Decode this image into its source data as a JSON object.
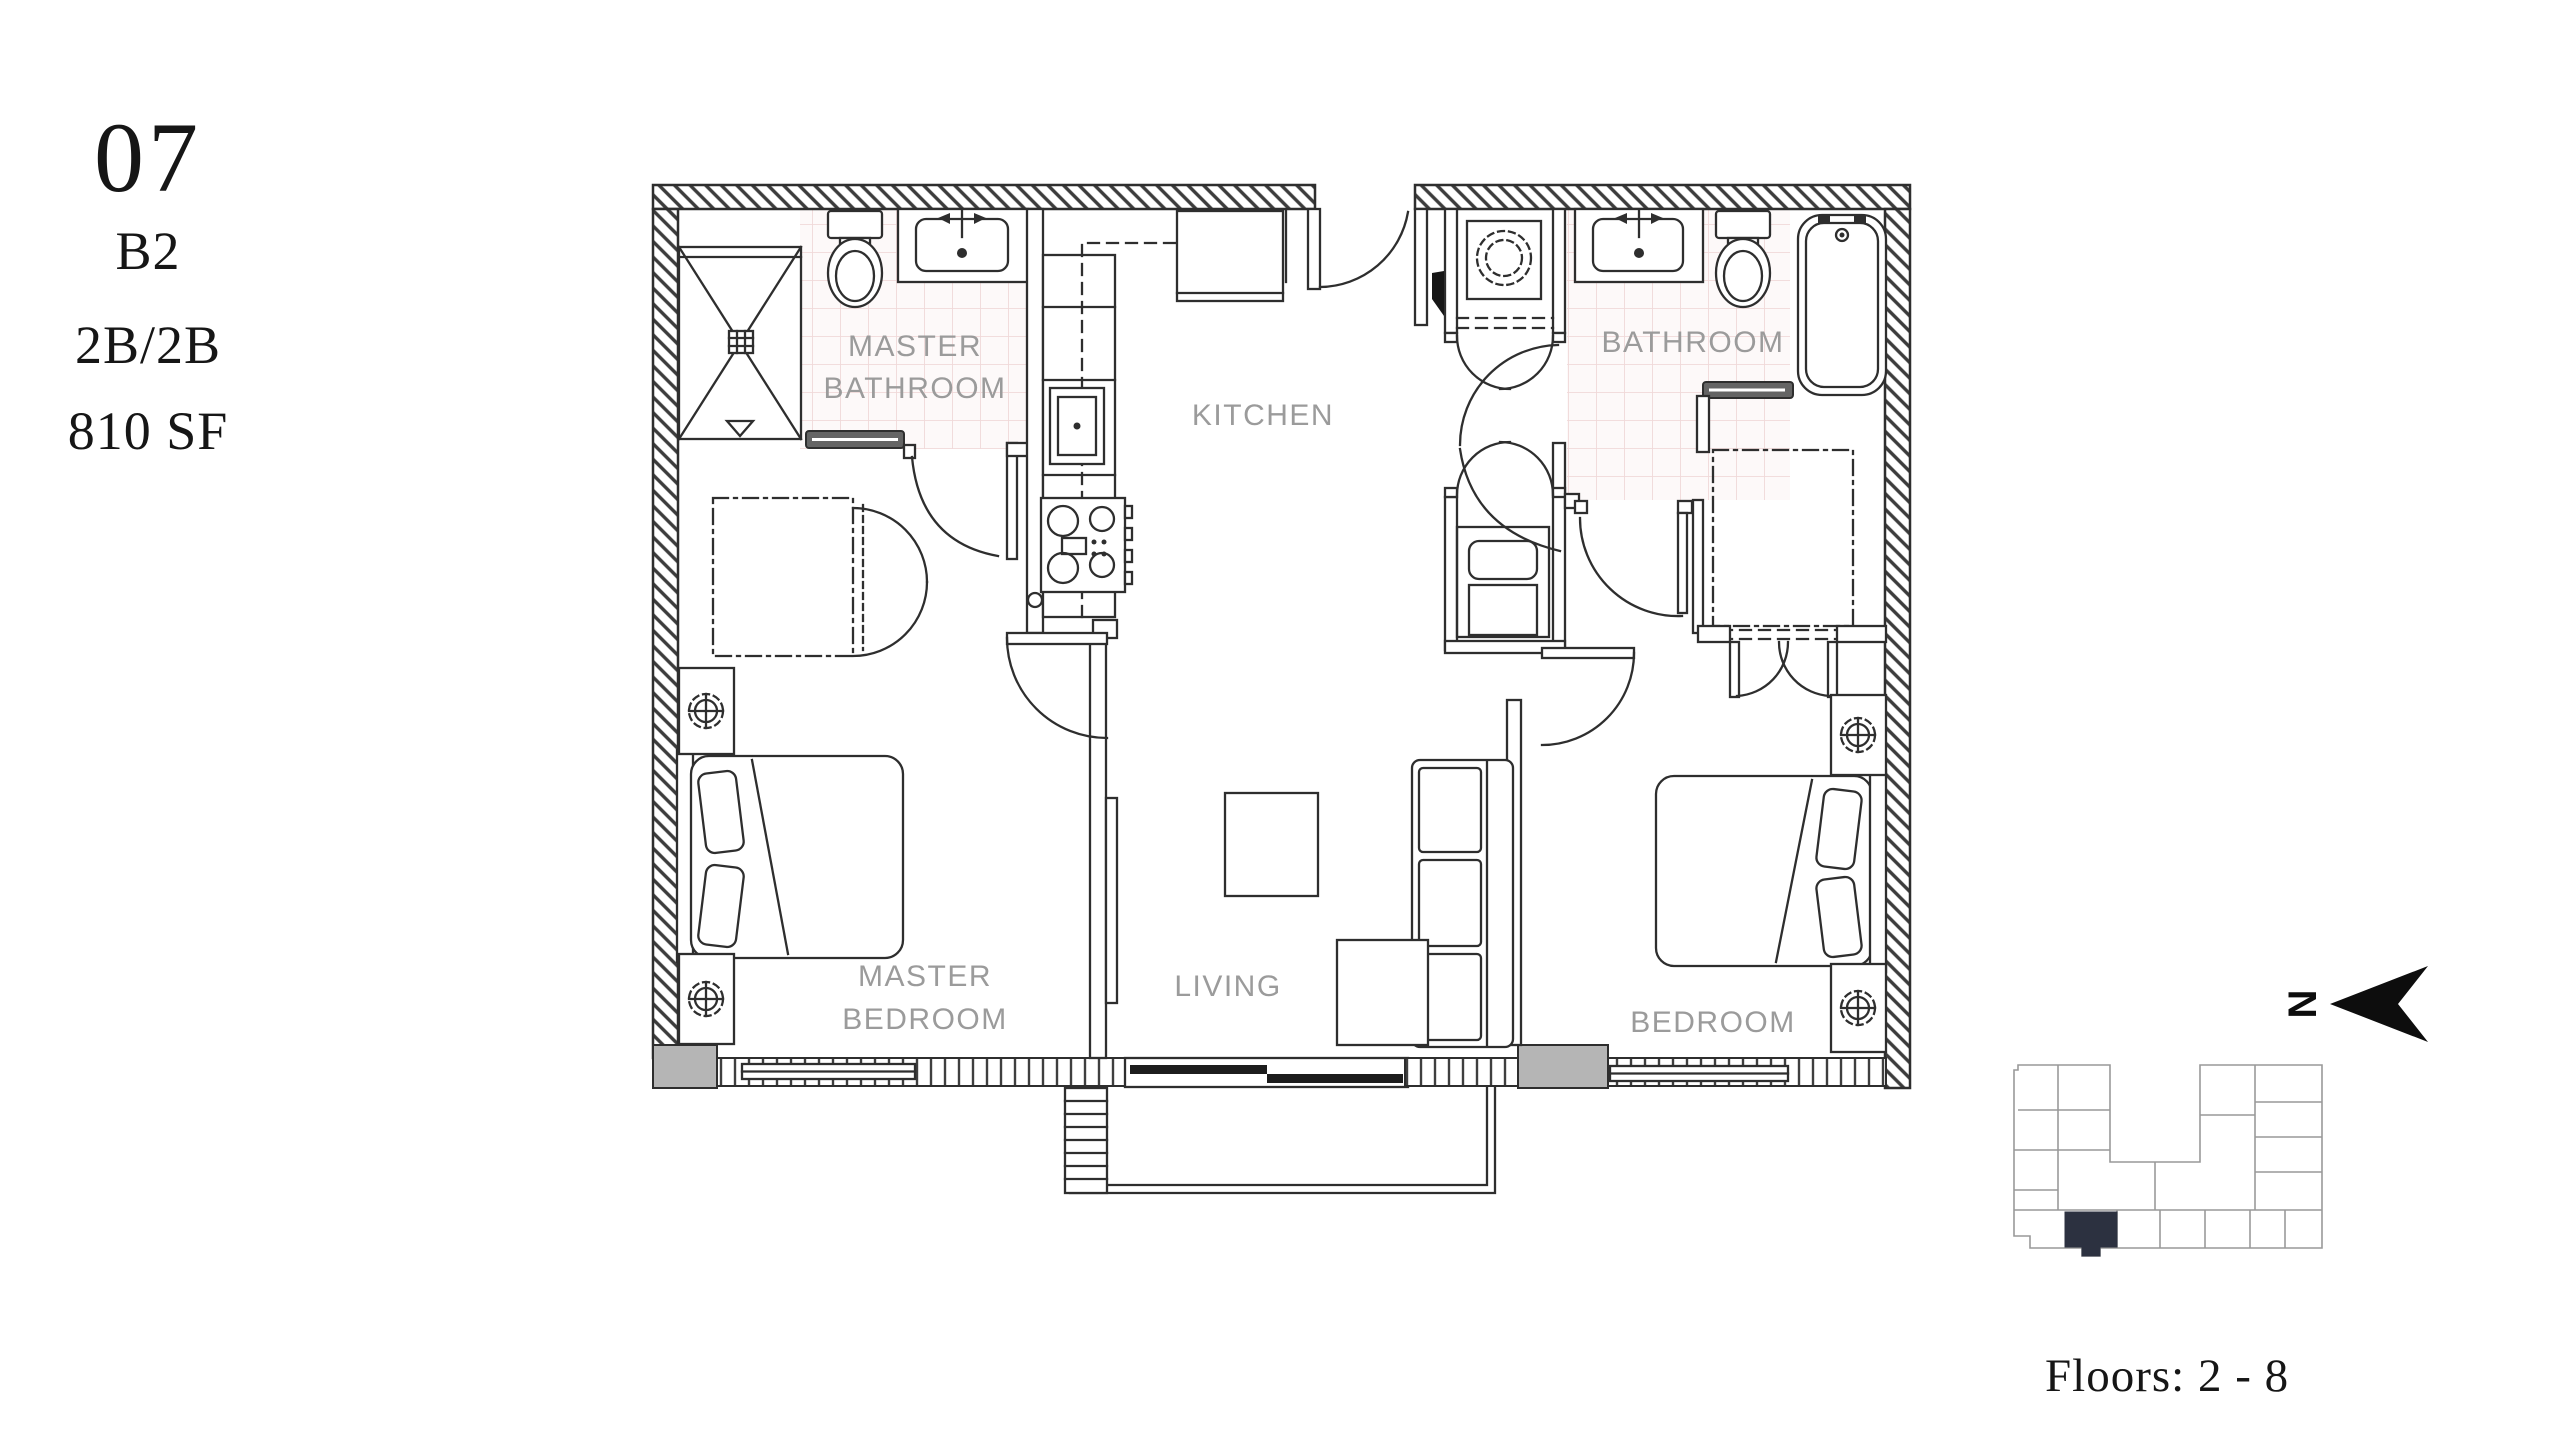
{
  "unit_info": {
    "number": "07",
    "plan_code": "B2",
    "beds_baths": "2B/2B",
    "area": "810 SF"
  },
  "rooms": {
    "master_bathroom": [
      "MASTER",
      "BATHROOM"
    ],
    "kitchen": "KITCHEN",
    "bathroom": "BATHROOM",
    "master_bedroom": [
      "MASTER",
      "BEDROOM"
    ],
    "living": "LIVING",
    "bedroom": "BEDROOM"
  },
  "key_plan": {
    "floors_label": "Floors: 2 - 8"
  },
  "compass": {
    "north_label": "N"
  },
  "colors": {
    "background": "#ffffff",
    "line": "#2e2e2e",
    "room_label": "#9b9b9b",
    "tile_line": "#f0d9d9",
    "tile_fill": "#fdf9f9",
    "threshold": "#646464",
    "gray_block": "#b5b5b5",
    "window_panel": "#1d1d1d",
    "keyplan_line": "#999999",
    "highlight_unit": "#2c3140",
    "text": "#161616"
  }
}
